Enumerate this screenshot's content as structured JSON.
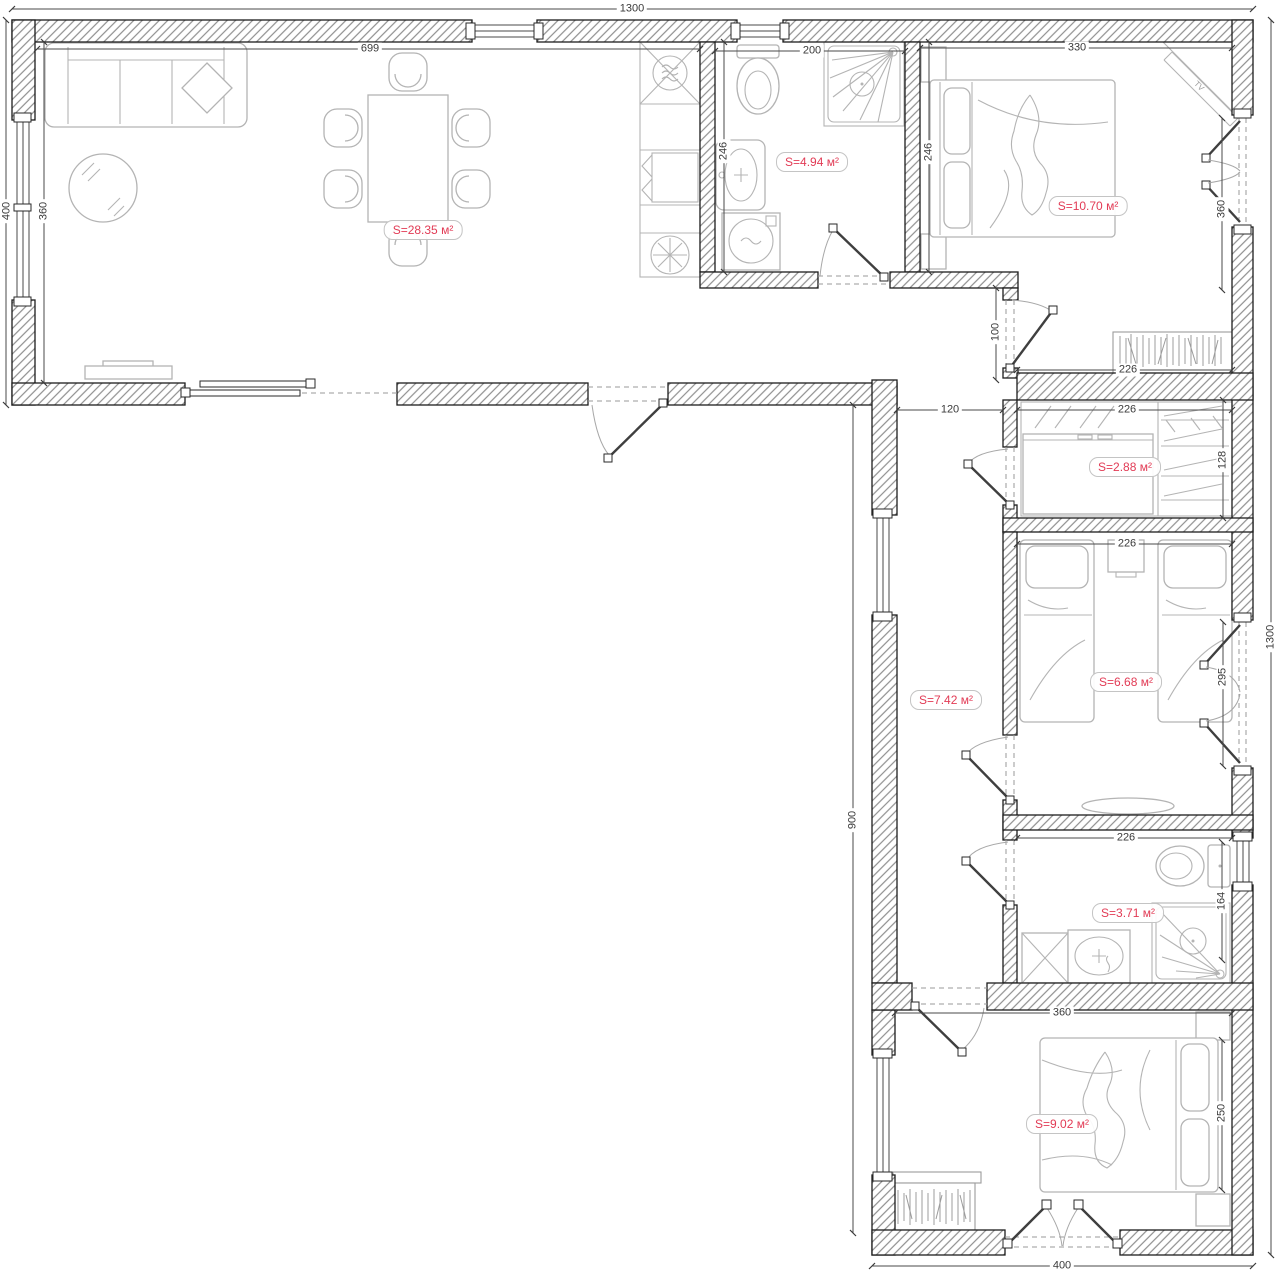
{
  "colors": {
    "area_label": "#e23b55",
    "walls": "#1c1c1c",
    "furniture": "#b4b4b4",
    "dimensions": "#3a3a3a"
  },
  "rooms": [
    {
      "name": "living-room",
      "area_label": "S=28.35 м²"
    },
    {
      "name": "bathroom-top",
      "area_label": "S=4.94 м²"
    },
    {
      "name": "bedroom-top-right",
      "area_label": "S=10.70 м²"
    },
    {
      "name": "closet",
      "area_label": "S=2.88 м²"
    },
    {
      "name": "hallway",
      "area_label": "S=7.42 м²"
    },
    {
      "name": "kids-room",
      "area_label": "S=6.68 м²"
    },
    {
      "name": "bathroom-bottom",
      "area_label": "S=3.71 м²"
    },
    {
      "name": "bedroom-bottom",
      "area_label": "S=9.02 м²"
    }
  ],
  "dimensions": {
    "overall_top": "1300",
    "overall_right": "1300",
    "overall_left": "400",
    "overall_bottom": "400",
    "living_width": "699",
    "living_depth": "360",
    "bath_top_width": "200",
    "bath_top_depth": "246",
    "bedroom_top_width": "330",
    "bedroom_top_depth": "246",
    "bedroom_top_window": "360",
    "bedroom_top_wardrobe": "226",
    "bedroom_top_door": "100",
    "hall_width": "120",
    "hall_length": "900",
    "closet_width": "226",
    "closet_depth": "128",
    "kids_width": "226",
    "kids_window": "295",
    "bath_bottom_width": "226",
    "bath_bottom_window": "164",
    "bedroom_bottom_width": "360",
    "bedroom_bottom_depth": "250"
  },
  "furniture": {
    "tv_label": "TV"
  }
}
